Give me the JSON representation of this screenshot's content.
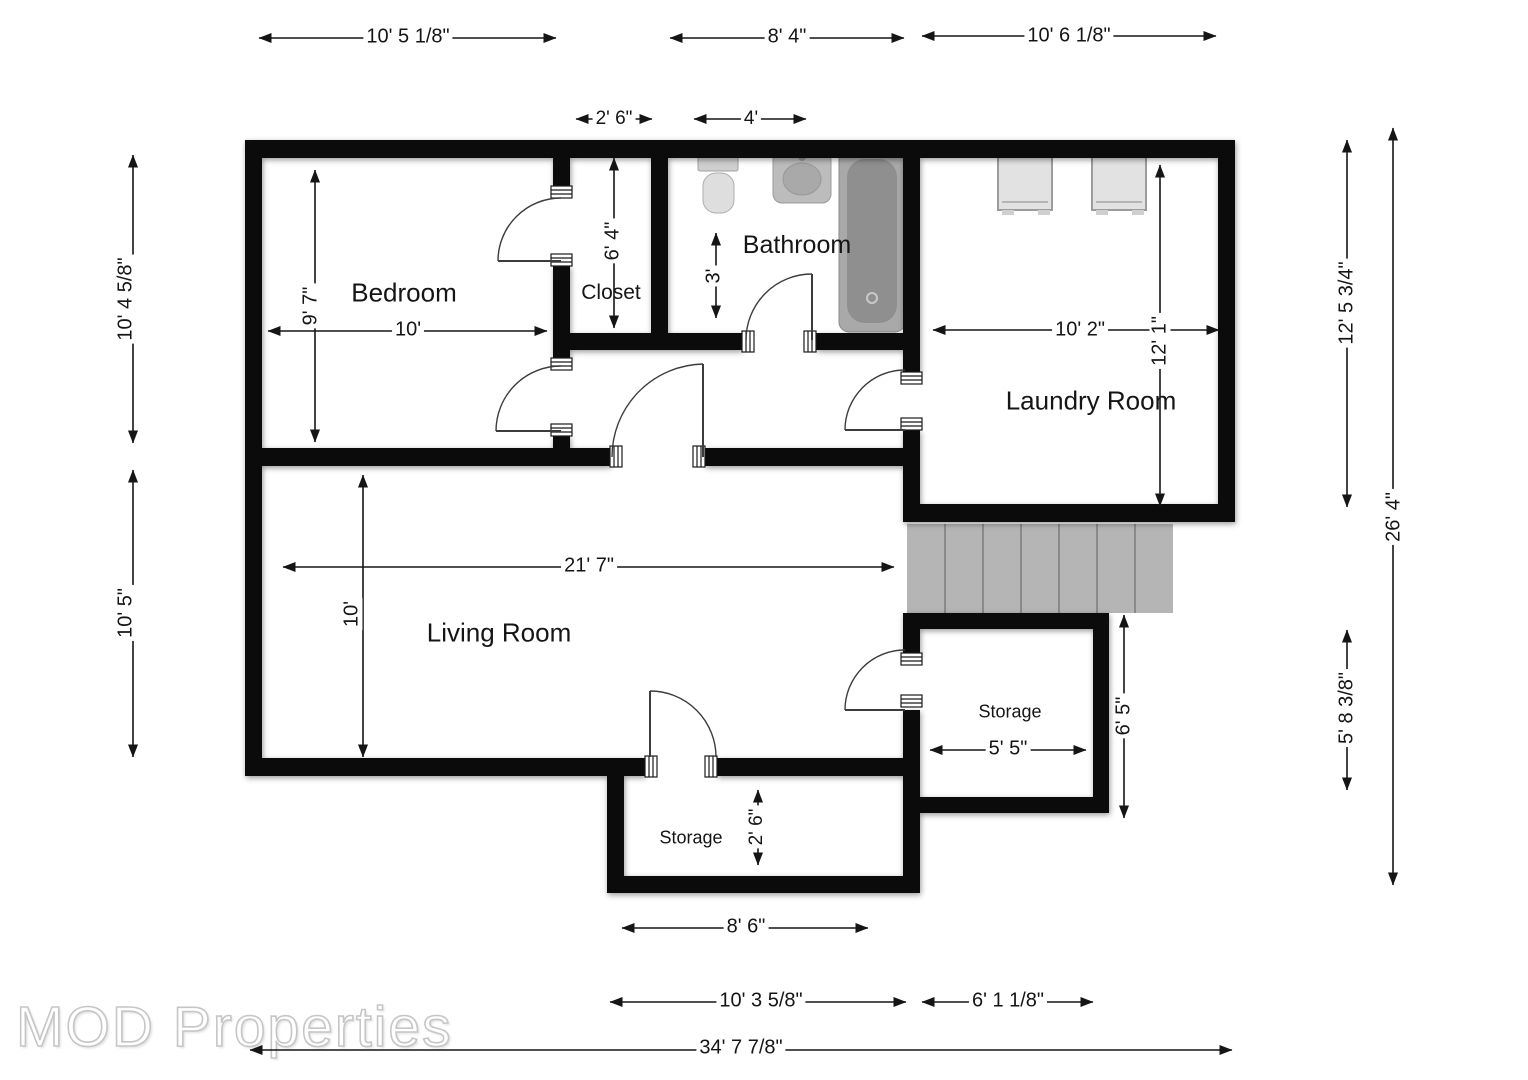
{
  "watermark": "MOD Properties",
  "rooms": {
    "bedroom": {
      "label": "Bedroom"
    },
    "closet": {
      "label": "Closet"
    },
    "bathroom": {
      "label": "Bathroom"
    },
    "laundry": {
      "label": "Laundry Room"
    },
    "living": {
      "label": "Living Room"
    },
    "storage_right": {
      "label": "Storage"
    },
    "storage_bottom": {
      "label": "Storage"
    }
  },
  "dimensions": {
    "top_bedroom": "10' 5 1/8\"",
    "top_bathroom": "8' 4\"",
    "top_laundry": "10' 6 1/8\"",
    "closet_width": "2' 6\"",
    "bath_front_width": "4'",
    "left_upper": "10' 4 5/8\"",
    "left_lower": "10' 5\"",
    "bedroom_height": "9' 7\"",
    "bedroom_width": "10'",
    "closet_height": "6' 4\"",
    "bath_clearance": "3'",
    "laundry_width": "10' 2\"",
    "laundry_height": "12' 1\"",
    "living_width": "21' 7\"",
    "living_height": "10'",
    "storage_right_width": "5' 5\"",
    "storage_right_height": "6' 5\"",
    "storage_bottom_height": "2' 6\"",
    "storage_bottom_width": "8' 6\"",
    "bottom_left_width": "10' 3 5/8\"",
    "bottom_right_width": "6' 1 1/8\"",
    "total_width": "34' 7 7/8\"",
    "right_laundry_height": "12' 5 3/4\"",
    "right_total_height": "26' 4\"",
    "right_storage_height": "5' 8 3/8\""
  }
}
